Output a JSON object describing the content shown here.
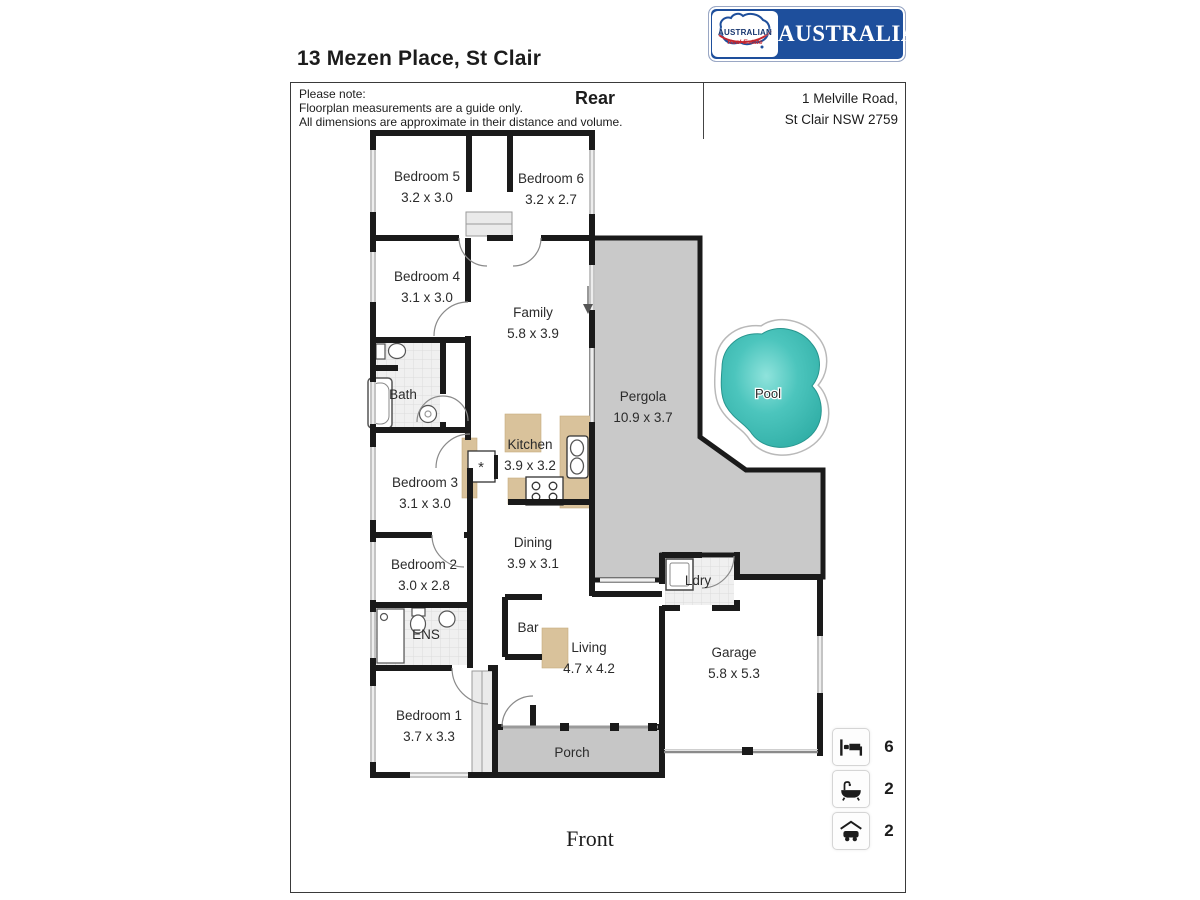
{
  "title": "13 Mezen Place, St Clair",
  "note": {
    "heading": "Please note:",
    "line1": "Floorplan measurements are a guide only.",
    "line2": "All dimensions are approximate in their distance and volume."
  },
  "orientation": {
    "rear": "Rear",
    "front": "Front"
  },
  "logo": {
    "brand": "AUSTRALIAN",
    "emblem_text": "AUSTRALIAN",
    "emblem_subtext": "Real Estate"
  },
  "address": {
    "line1": "1 Melville Road,",
    "line2": "St Clair NSW 2759"
  },
  "rooms": {
    "bedroom5": {
      "name": "Bedroom 5",
      "dims": "3.2 x 3.0"
    },
    "bedroom6": {
      "name": "Bedroom 6",
      "dims": "3.2 x 2.7"
    },
    "bedroom4": {
      "name": "Bedroom 4",
      "dims": "3.1 x 3.0"
    },
    "family": {
      "name": "Family",
      "dims": "5.8 x 3.9"
    },
    "bath": {
      "name": "Bath"
    },
    "kitchen": {
      "name": "Kitchen",
      "dims": "3.9 x 3.2"
    },
    "bedroom3": {
      "name": "Bedroom 3",
      "dims": "3.1 x 3.0"
    },
    "pergola": {
      "name": "Pergola",
      "dims": "10.9 x 3.7"
    },
    "pool": {
      "name": "Pool"
    },
    "dining": {
      "name": "Dining",
      "dims": "3.9 x 3.1"
    },
    "bedroom2": {
      "name": "Bedroom 2",
      "dims": "3.0 x 2.8"
    },
    "ldry": {
      "name": "Ldry"
    },
    "bar": {
      "name": "Bar"
    },
    "living": {
      "name": "Living",
      "dims": "4.7 x 4.2"
    },
    "ens": {
      "name": "ENS"
    },
    "garage": {
      "name": "Garage",
      "dims": "5.8 x 5.3"
    },
    "bedroom1": {
      "name": "Bedroom 1",
      "dims": "3.7 x 3.3"
    },
    "porch": {
      "name": "Porch"
    }
  },
  "symbols": {
    "appliance": "*"
  },
  "legend": [
    {
      "icon": "bed-icon",
      "count": "6"
    },
    {
      "icon": "bath-icon",
      "count": "2"
    },
    {
      "icon": "car-icon",
      "count": "2"
    }
  ],
  "colors": {
    "wall": "#1a1a1a",
    "pergola_fill": "#c9c9c9",
    "porch_fill": "#c6c6c6",
    "bench_fill": "#d9c29b",
    "pool_fill": "#3fbdb5",
    "brand_blue": "#1e4f9c",
    "brand_red": "#c4262e"
  }
}
